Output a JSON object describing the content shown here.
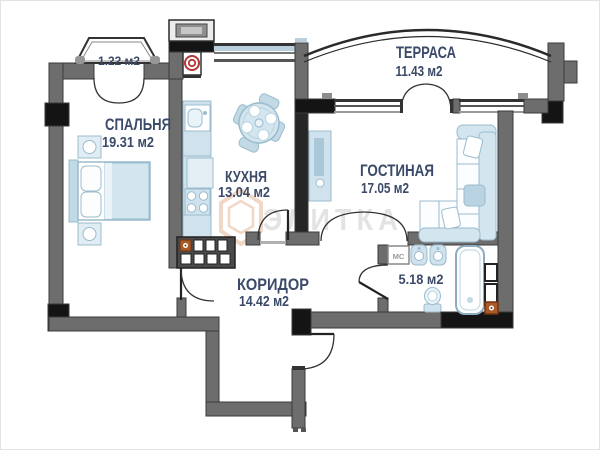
{
  "floor_plan": {
    "watermark": {
      "text": "ЭЛИТКА"
    },
    "rooms": [
      {
        "id": "bedroom",
        "name": "СПАЛЬНЯ",
        "area": "19.31 м2"
      },
      {
        "id": "kitchen",
        "name": "КУХНЯ",
        "area": "13.04 м2"
      },
      {
        "id": "living_room",
        "name": "ГОСТИНАЯ",
        "area": "17.05 м2"
      },
      {
        "id": "terrace",
        "name": "ТЕРРАСА",
        "area": "11.43 м2"
      },
      {
        "id": "corridor",
        "name": "КОРИДОР",
        "area": "14.42 м2"
      },
      {
        "id": "bathroom",
        "name": "",
        "area": "5.18 м2"
      },
      {
        "id": "balcony",
        "name": "",
        "area": "1.22 м2"
      }
    ],
    "labels": {
      "washing_machine": "МС"
    },
    "colors": {
      "wall": "#6d6d6d",
      "wall_dark": "#141414",
      "divider_dark": "#262626",
      "furniture_fill": "#d3e5ef",
      "furniture_stroke": "#9bbccd",
      "text": "#3a4a68",
      "watermark_text": "#e3e3e3",
      "watermark_logo": "#f1d7c5",
      "vent_red": "#b23535",
      "accent_orange": "#aa5a28",
      "glazing_blue": "#b9cfdd"
    }
  }
}
